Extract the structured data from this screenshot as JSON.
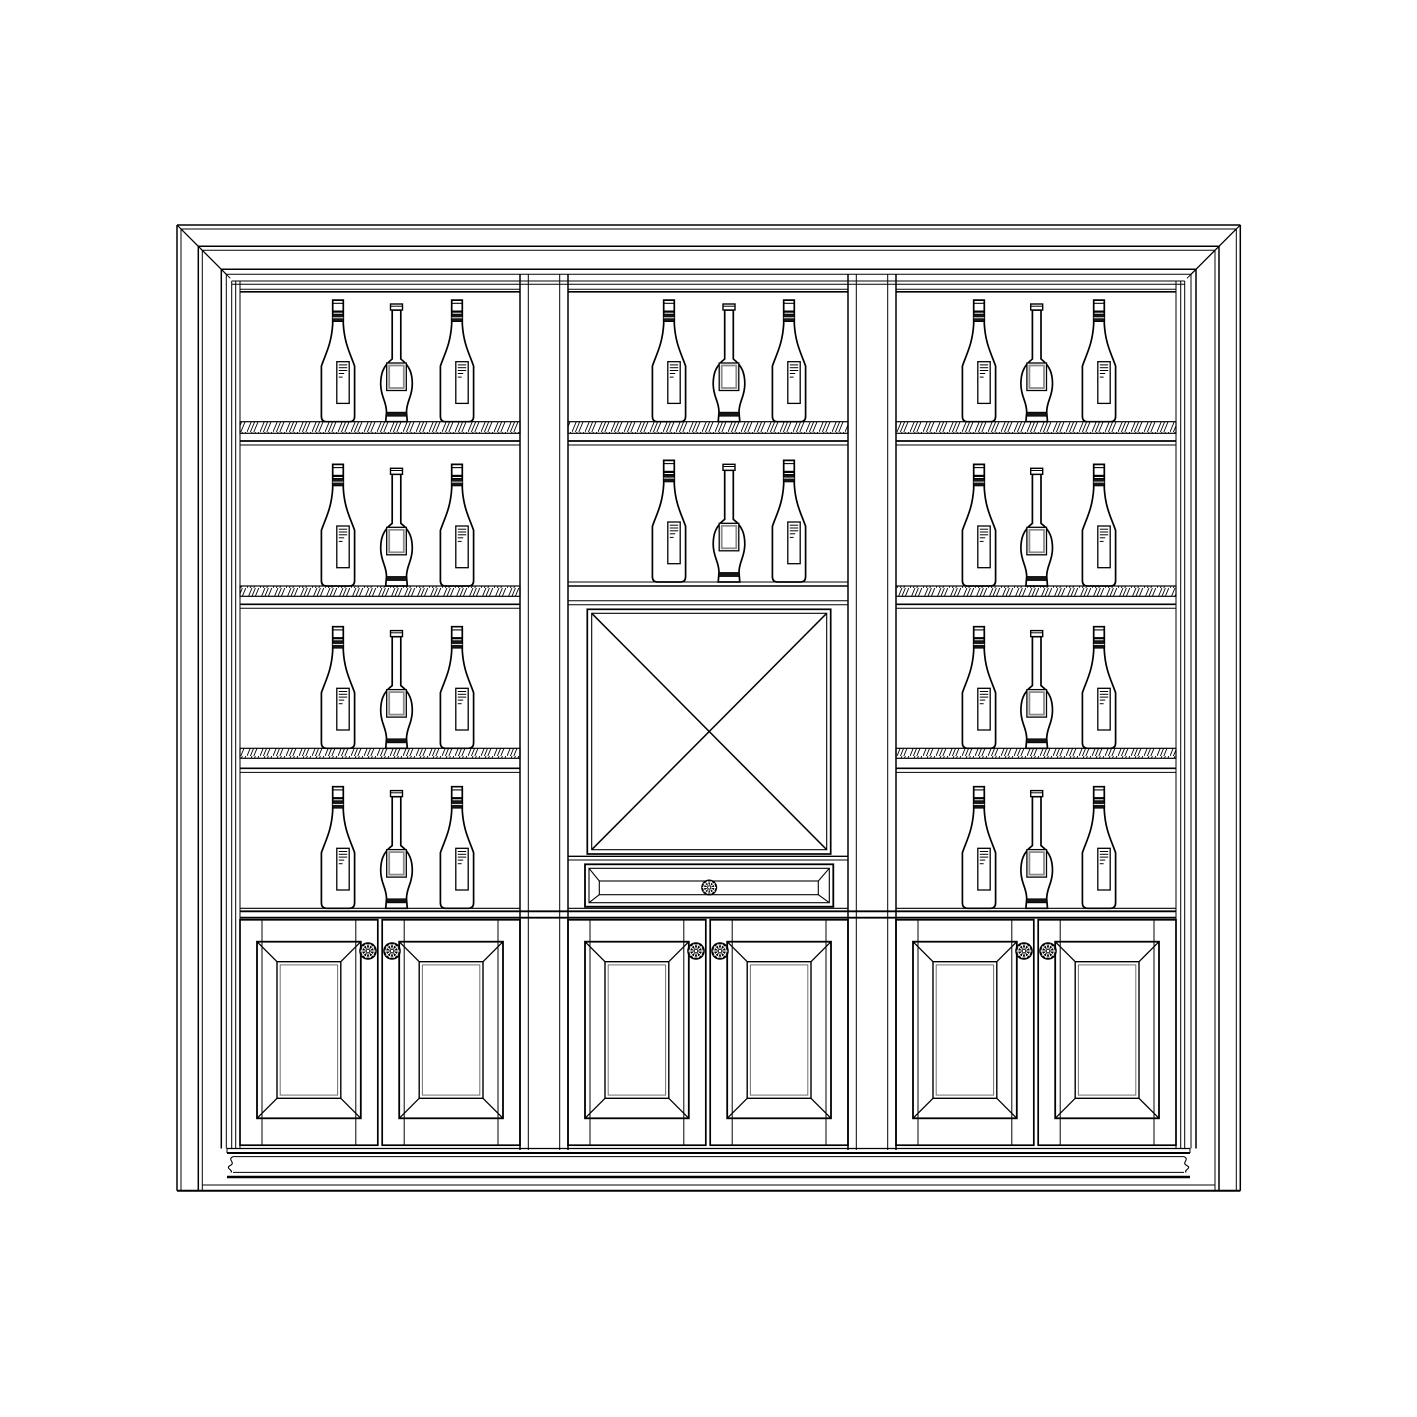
{
  "drawing": {
    "subject": "built-in-bar-wine-cabinet-front-elevation",
    "style": {
      "background": "#ffffff",
      "line_color": "#000000",
      "dark_fill": "#161616",
      "panel_inner_gray": "#6e6e6e",
      "label_border_gray": "#8a8a8a"
    },
    "canvas": {
      "width": 1417,
      "height": 1417
    }
  },
  "summary": {
    "sections": 3,
    "bottles_total": 30,
    "wine_bottles": 20,
    "decanter_bottles": 10,
    "hatched_shelves": 7,
    "doors": 6,
    "drawers": 1,
    "door_knobs": 6,
    "drawer_knobs": 1,
    "wine_rack_x_panels": 1
  },
  "geometry": {
    "casing": {
      "top_y": [
        225,
        229,
        246.3,
        250.3,
        269.3,
        274.3
      ],
      "left_x": [
        177,
        181,
        198.3,
        202.3,
        221.3,
        226.3
      ],
      "right_x": [
        1240.3,
        1236.3,
        1219,
        1215,
        1196,
        1191
      ],
      "floor_y": 1190.8,
      "molding_top_y": 1148.5
    },
    "face": {
      "left_x": [
        231.7,
        235.7,
        240
      ],
      "right_x": [
        1184.7,
        1180.7,
        1176
      ],
      "top_y": [
        281,
        284.3
      ],
      "bottom_y": 1148.5
    },
    "sections": {
      "left": {
        "x1": 240,
        "x2": 520
      },
      "center": {
        "x1": 568,
        "x2": 848
      },
      "right": {
        "x1": 896,
        "x2": 1176
      }
    },
    "stiles": [
      {
        "x": [
          520,
          528.3,
          559.7,
          568
        ]
      },
      {
        "x": [
          848,
          856.3,
          887.7,
          896
        ]
      }
    ],
    "stile_y": [
      274.3,
      1150
    ],
    "top_rail_y": [
      289.3,
      291.8
    ],
    "shelves": [
      {
        "y": 421.7,
        "h": 11.6,
        "lines": [
          441,
          445
        ]
      },
      {
        "y": 586,
        "h": 10.3,
        "lines": [
          604.3,
          608.3
        ]
      },
      {
        "y": 748.3,
        "h": 10,
        "lines": [
          768.3,
          772.4
        ]
      }
    ],
    "counter": {
      "ledge_y": 908.3,
      "band_y": [
        911.3,
        917.7
      ]
    },
    "bottle_rows": {
      "left": {
        "x": [
          338,
          396.5,
          457
        ],
        "base_y": [
          421.7,
          586,
          748.3,
          908.3
        ]
      },
      "center": {
        "x": [
          669,
          729,
          789
        ],
        "base_y": [
          421.7,
          582
        ]
      },
      "right": {
        "x": [
          979,
          1036.7,
          1099
        ],
        "base_y": [
          421.7,
          586,
          748.3,
          908.3
        ]
      }
    },
    "bottle_pattern": [
      "wine",
      "decanter",
      "wine"
    ],
    "wine_bottle": {
      "height": 121.6,
      "body_half_w": 16.6,
      "neck_half_w": 5.3
    },
    "decanter": {
      "height": 117.7,
      "body_half_w": 15.8,
      "neck_half_w": 4.3
    },
    "x_rack": {
      "top_band_y": [
        582,
        586,
        600.7,
        604.7
      ],
      "outer": [
        587.3,
        609.3,
        830.7,
        854
      ],
      "inner": [
        591.7,
        613.3,
        826.7,
        849.7
      ],
      "bottom_band_y": [
        856.3,
        860
      ]
    },
    "drawer": {
      "outer": [
        585,
        864.3,
        833.3,
        906.7
      ],
      "mid": [
        589,
        868.3,
        829.3,
        902.7
      ],
      "inner": [
        599.3,
        881,
        818.3,
        894.7
      ],
      "knob": {
        "x": 709.2,
        "y": 887.5,
        "r": 8
      }
    },
    "doors": {
      "y1": 919.8,
      "y2": 1145.2,
      "gap": 4.4,
      "stile_inset": 22,
      "panel_inset_x": 17,
      "panel_y": [
        941.7,
        1118.3
      ],
      "bevel": 20,
      "inner_gap": 3.2
    },
    "door_knobs": {
      "y": 951,
      "offset_from_gap": 12,
      "r": 8.8
    },
    "base": {
      "lines": [
        {
          "y": 1148.5,
          "x1": 227,
          "x2": 1190,
          "w": 1.2
        },
        {
          "y": 1153,
          "x1": 227,
          "x2": 1190,
          "w": 2
        },
        {
          "y": 1156.6,
          "x1": 233,
          "x2": 1184,
          "w": 1
        },
        {
          "y": 1172.4,
          "x1": 233,
          "x2": 1184,
          "w": 1
        },
        {
          "y": 1177,
          "x1": 227,
          "x2": 1190,
          "w": 2.4
        },
        {
          "y": 1185,
          "x1": 202.3,
          "x2": 1215,
          "w": 1
        },
        {
          "y": 1190.8,
          "x1": 177,
          "x2": 1240.3,
          "w": 2
        }
      ],
      "squiggle_left": "M233,1156.6 C226.5,1159.8 236.5,1162.4 230,1165.6 C224.8,1168.4 233.8,1170.2 230.8,1172.4",
      "squiggle_right": "M1184,1156.6 C1190.5,1159.8 1180.5,1162.4 1187,1165.6 C1192.2,1168.4 1183.2,1170.2 1186.2,1172.4"
    }
  }
}
